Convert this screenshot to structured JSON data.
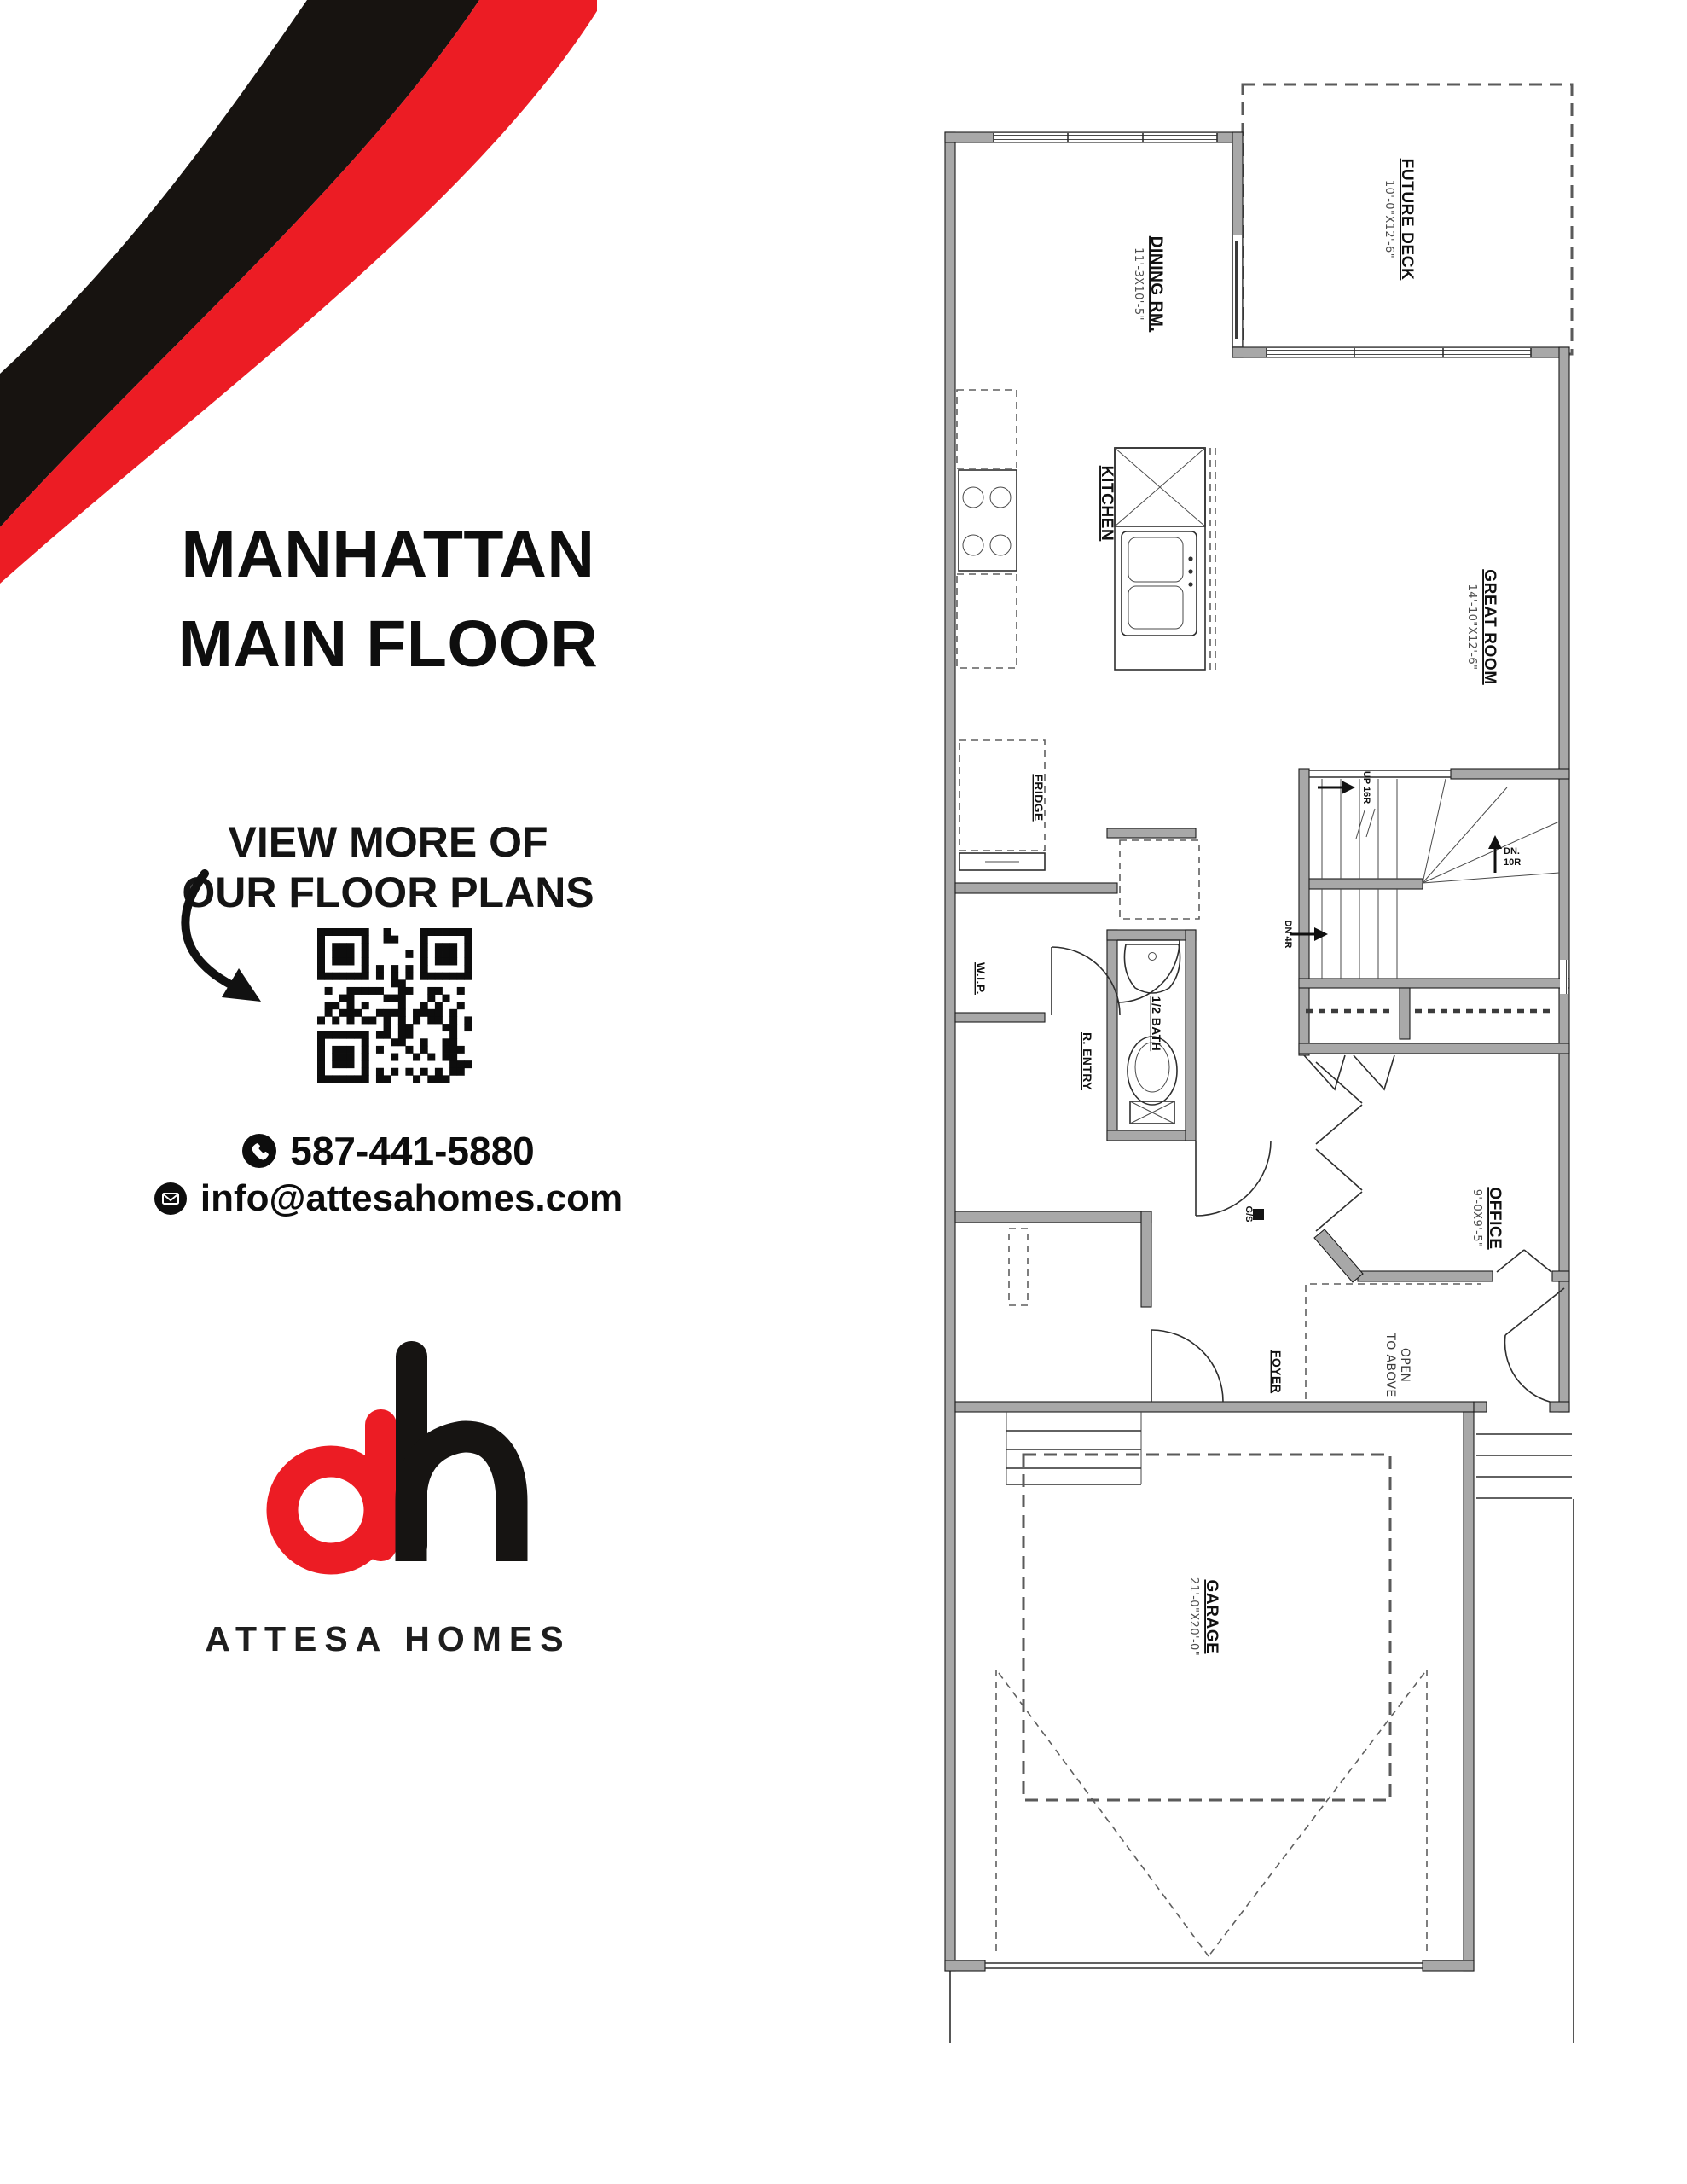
{
  "title": {
    "line1": "MANHATTAN",
    "line2": "MAIN FLOOR"
  },
  "cta": {
    "line1": "VIEW MORE OF",
    "line2": "OUR FLOOR PLANS"
  },
  "contact": {
    "phone": "587-441-5880",
    "email": "info@attesahomes.com"
  },
  "brand": {
    "name": "ATTESA HOMES",
    "logo_red": "#ec1c24",
    "logo_black": "#161412"
  },
  "decor": {
    "stripe_black": "#171310",
    "stripe_red": "#ec1c24"
  },
  "floorplan": {
    "rooms": {
      "dining": {
        "name": "DINING RM.",
        "dim": "11'-3X10'-5\""
      },
      "deck": {
        "name": "FUTURE DECK",
        "dim": "10'-0\"X12'-6\""
      },
      "great": {
        "name": "GREAT ROOM",
        "dim": "14'-10\"X12'-6\""
      },
      "kitchen": {
        "name": "KITCHEN"
      },
      "fridge": {
        "name": "FRIDGE"
      },
      "wip": {
        "name": "W.I.P."
      },
      "rentry": {
        "name": "R. ENTRY"
      },
      "halfbath": {
        "name": "1/2 BATH"
      },
      "office": {
        "name": "OFFICE",
        "dim": "9'-0X9'-5\""
      },
      "foyer": {
        "name": "FOYER"
      },
      "open_above": {
        "line1": "OPEN",
        "line2": "TO ABOVE"
      },
      "garage": {
        "name": "GARAGE",
        "dim": "21'-0\"X20'-0\""
      }
    },
    "stairs": {
      "up": "UP 16R",
      "dn4": "DN 4R",
      "dn10_l1": "DN.",
      "dn10_l2": "10R"
    },
    "symbols": {
      "gs": "G/S"
    }
  }
}
